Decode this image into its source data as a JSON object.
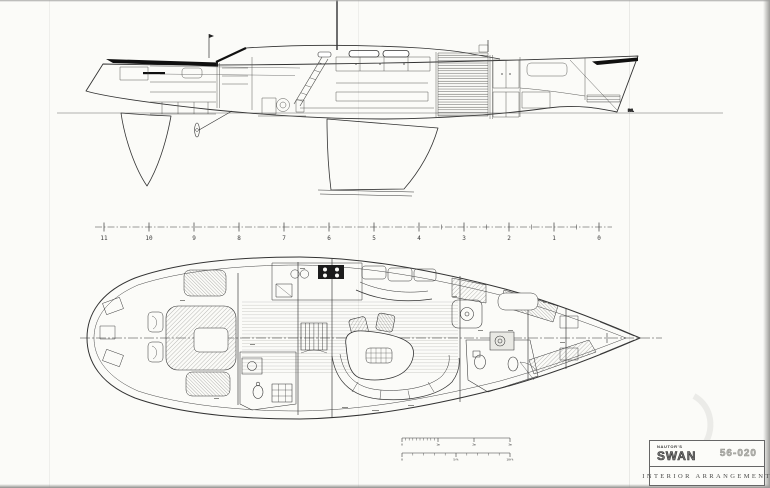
{
  "page": {
    "background": "#fbfbf8",
    "ink": "#333333"
  },
  "waterline_label": "DWL",
  "station_ruler": {
    "stations": [
      "11",
      "10",
      "9",
      "8",
      "7",
      "6",
      "5",
      "4",
      "3",
      "2",
      "1",
      "0"
    ]
  },
  "scale_bars": {
    "meters": {
      "labels": [
        "0",
        "1m",
        "2m",
        "3m"
      ]
    },
    "feet": {
      "labels": [
        "0",
        "5ft",
        "10ft"
      ]
    }
  },
  "title_block": {
    "brand_small": "NAUTOR'S",
    "brand_large": "SWAN",
    "model": "56-020",
    "title": "INTERIOR ARRANGEMENT"
  }
}
